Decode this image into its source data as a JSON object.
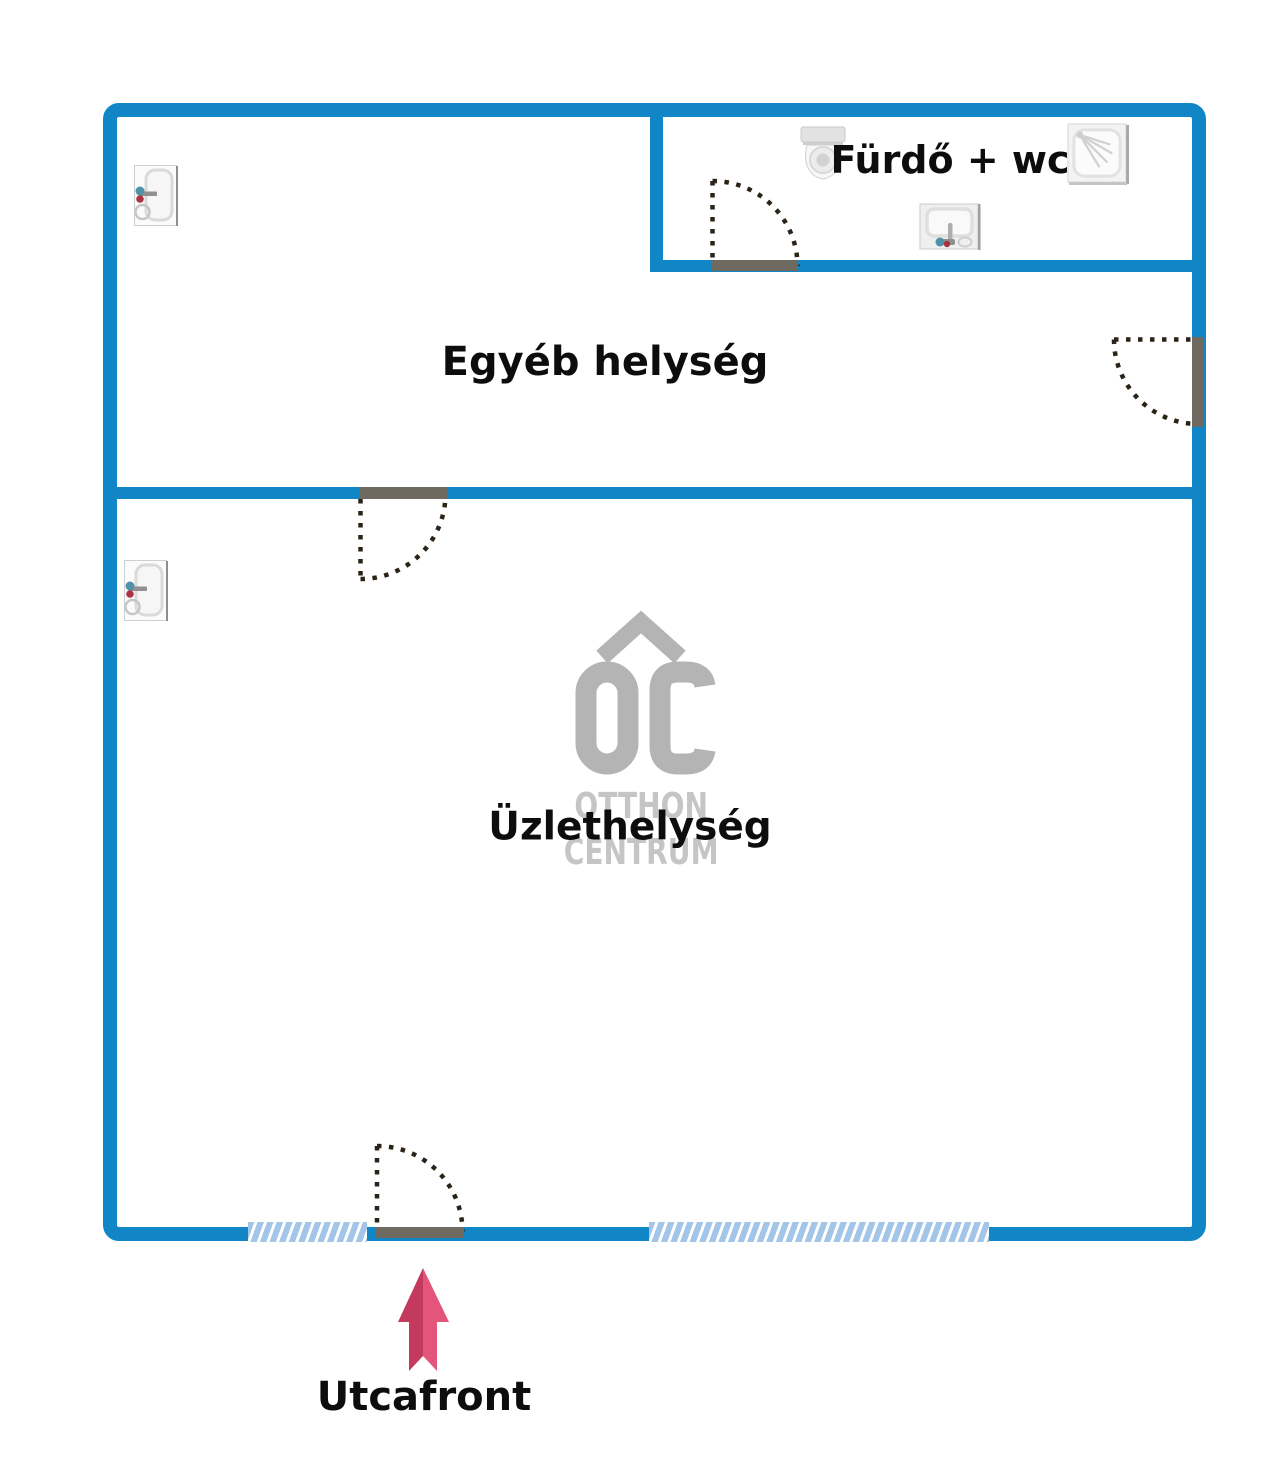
{
  "labels": {
    "room_other": "Egyéb helység",
    "bathroom": "Fürdő + wc",
    "shop": "Üzlethelység",
    "street_front": "Utcafront"
  },
  "logo": {
    "monogram": "OC",
    "line1": "OTTHON",
    "line2": "CENTRUM"
  },
  "icons": {
    "door_icons": [
      "door-icon",
      "door-icon"
    ],
    "bathroom_fixtures": [
      "toilet-icon",
      "shower-icon",
      "sink-icon"
    ],
    "street_arrow": "arrow-up-icon"
  },
  "colors": {
    "wall_blue": "#1186c7",
    "door_leaf_gray": "#6f6a5f",
    "swing_dash": "#2b2218",
    "window_blue": "#a3c6e8",
    "logo_gray": "#b4b4b4",
    "logo_text_gray": "#c5c5c5",
    "arrow_dark_pink": "#c43a5e",
    "arrow_light_pink": "#e3557a",
    "label_text": "#0d0d0d"
  }
}
